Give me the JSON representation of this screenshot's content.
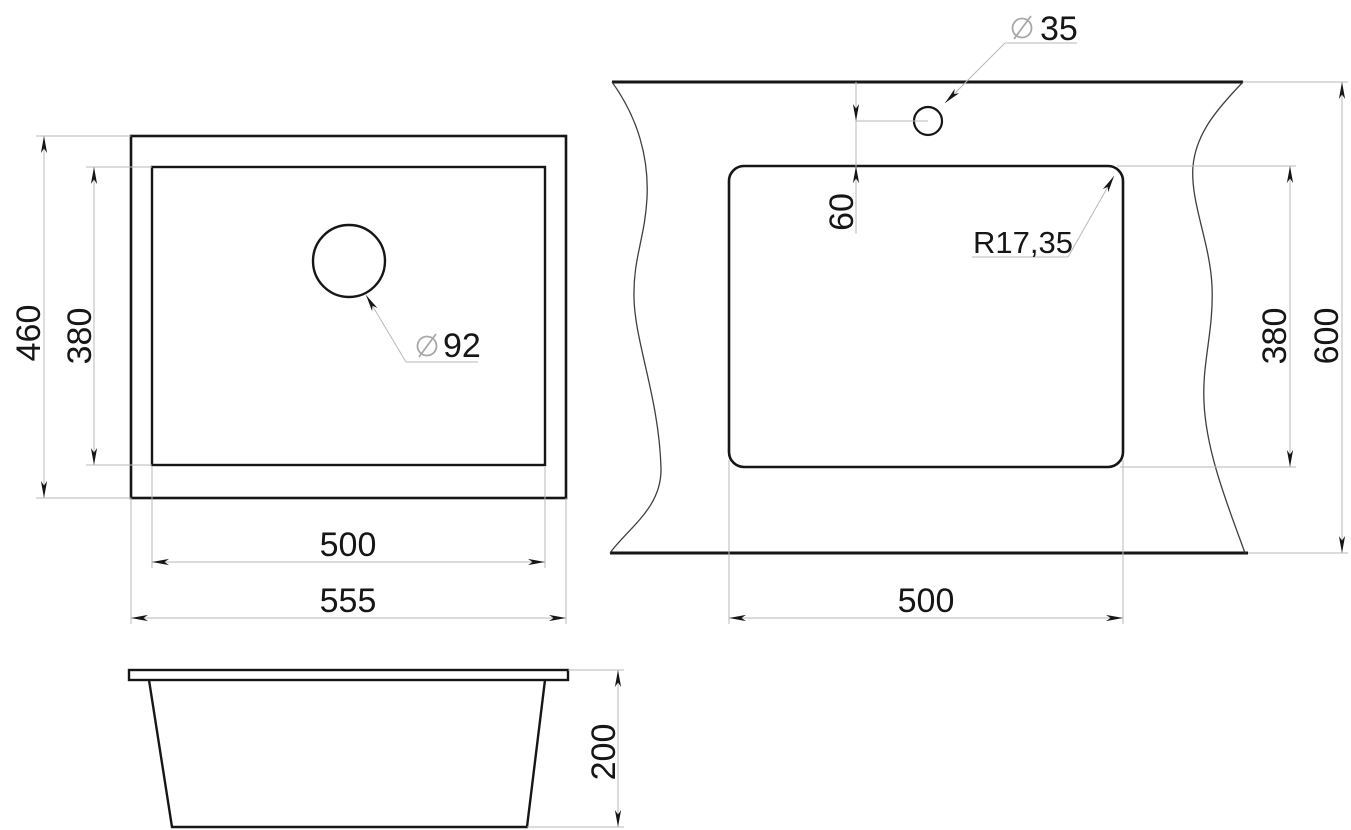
{
  "drawing": {
    "background": "#ffffff",
    "outline_color": "#161616",
    "dimension_line_color": "#b9b9b9",
    "symbol_color": "#a8a8a8",
    "top_view": {
      "height_outer": "460",
      "height_inner": "380",
      "drain_symbol": "⌀",
      "drain_diameter": "92",
      "width_inner": "500",
      "width_outer": "555"
    },
    "side_view": {
      "depth": "200"
    },
    "cutout_view": {
      "hole_symbol": "⌀",
      "hole_diameter": "35",
      "hole_offset": "60",
      "corner_radius": "R17,35",
      "cutout_height": "380",
      "counter_depth": "600",
      "cutout_width": "500"
    }
  }
}
